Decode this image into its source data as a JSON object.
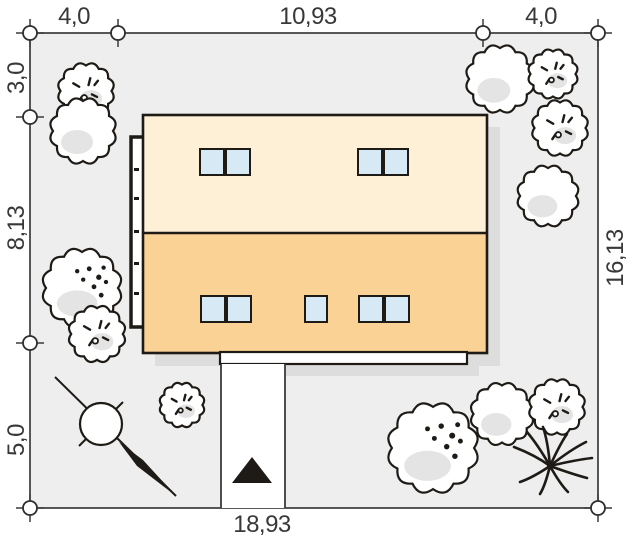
{
  "dimensions": {
    "top": [
      "4,0",
      "10,93",
      "4,0"
    ],
    "left": [
      "3,0",
      "8,13",
      "5,0"
    ],
    "right": [
      "16,13"
    ],
    "bottom": [
      "18,93"
    ]
  },
  "colors": {
    "line": "#1e1b16",
    "plot_fill": "#eeeeee",
    "plot_border": "#2f2f2f",
    "roof_upper": "#fdf0d6",
    "roof_lower": "#fbd295",
    "window_glass": "#d8e9f6",
    "shadow": "#dddddd",
    "tree_shade": "#e4e4e4",
    "text": "#383838",
    "page_background": "#ffffff"
  }
}
